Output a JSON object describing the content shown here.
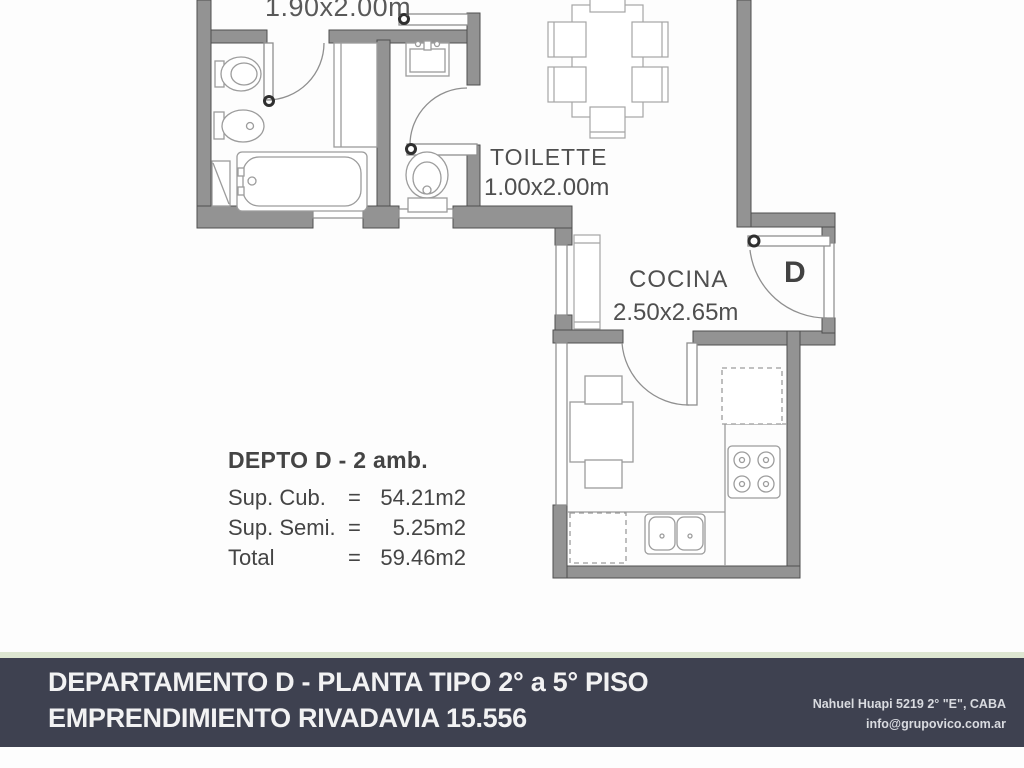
{
  "plan": {
    "top_room_dim": "1.90x2.00m",
    "toilette_name": "TOILETTE",
    "toilette_dim": "1.00x2.00m",
    "cocina_name": "COCINA",
    "cocina_dim": "2.50x2.65m",
    "entrance_letter": "D",
    "summary": {
      "title": "DEPTO D - 2 amb.",
      "rows": [
        {
          "label": "Sup. Cub.",
          "eq": "=",
          "value": "54.21m2"
        },
        {
          "label": "Sup. Semi.",
          "eq": "=",
          "value": "5.25m2"
        },
        {
          "label": "Total",
          "eq": "=",
          "value": "59.46m2"
        }
      ]
    }
  },
  "banner": {
    "line1": "DEPARTAMENTO D - PLANTA TIPO 2° a 5° PISO",
    "line2": "EMPRENDIMIENTO RIVADAVIA 15.556",
    "contact1": "Nahuel Huapi 5219 2° \"E\", CABA",
    "contact2": "info@grupovico.com.ar"
  },
  "colors": {
    "wall_fill": "#939393",
    "wall_stroke": "#4f4f4f",
    "fixture_stroke": "#9c9c9c",
    "text": "#4f4f4f",
    "banner_bg": "#3e4150",
    "banner_accent": "#dde6d1",
    "banner_text": "#f2f2f3"
  }
}
